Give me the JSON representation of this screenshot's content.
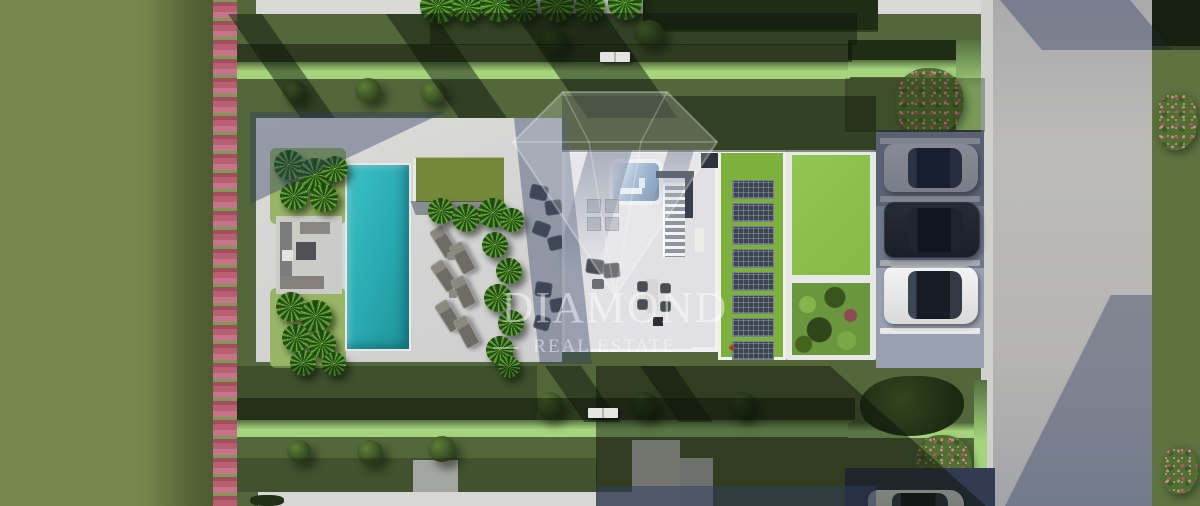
{
  "scene": {
    "type": "aerial-architectural-render-of-villa-plot",
    "watermark": {
      "brand": "DIAMOND",
      "tagline": "REAL ESTATE",
      "mark": "◆",
      "text_color": "rgba(255,255,255,0.48)",
      "mark_color": "#b03a2e"
    },
    "palette": {
      "field_grass": "#75854c",
      "lawn_grass": "#52643a",
      "hedge_bright": "#a5d47c",
      "hedge_dark": "#202d15",
      "flower_pink": "#c46f85",
      "paving_light": "#d6d6d5",
      "roof_white": "#e1e1e4",
      "pool_teal": "#29a9b1",
      "pergola_green": "#75883a",
      "green_roof": "#7cb13d",
      "solar_panel": "#3e4452",
      "road_gray": "#b4b3b1",
      "shadow_blue": "rgba(45,60,95,0.40)",
      "car_white": "#ececec",
      "car_black": "#20242b"
    },
    "objects": {
      "cars": [
        "white",
        "black",
        "white"
      ],
      "solar_panel_count": 8,
      "parking_space_count": 3,
      "sun_lounger_count": 6,
      "pool_count": 1
    }
  }
}
